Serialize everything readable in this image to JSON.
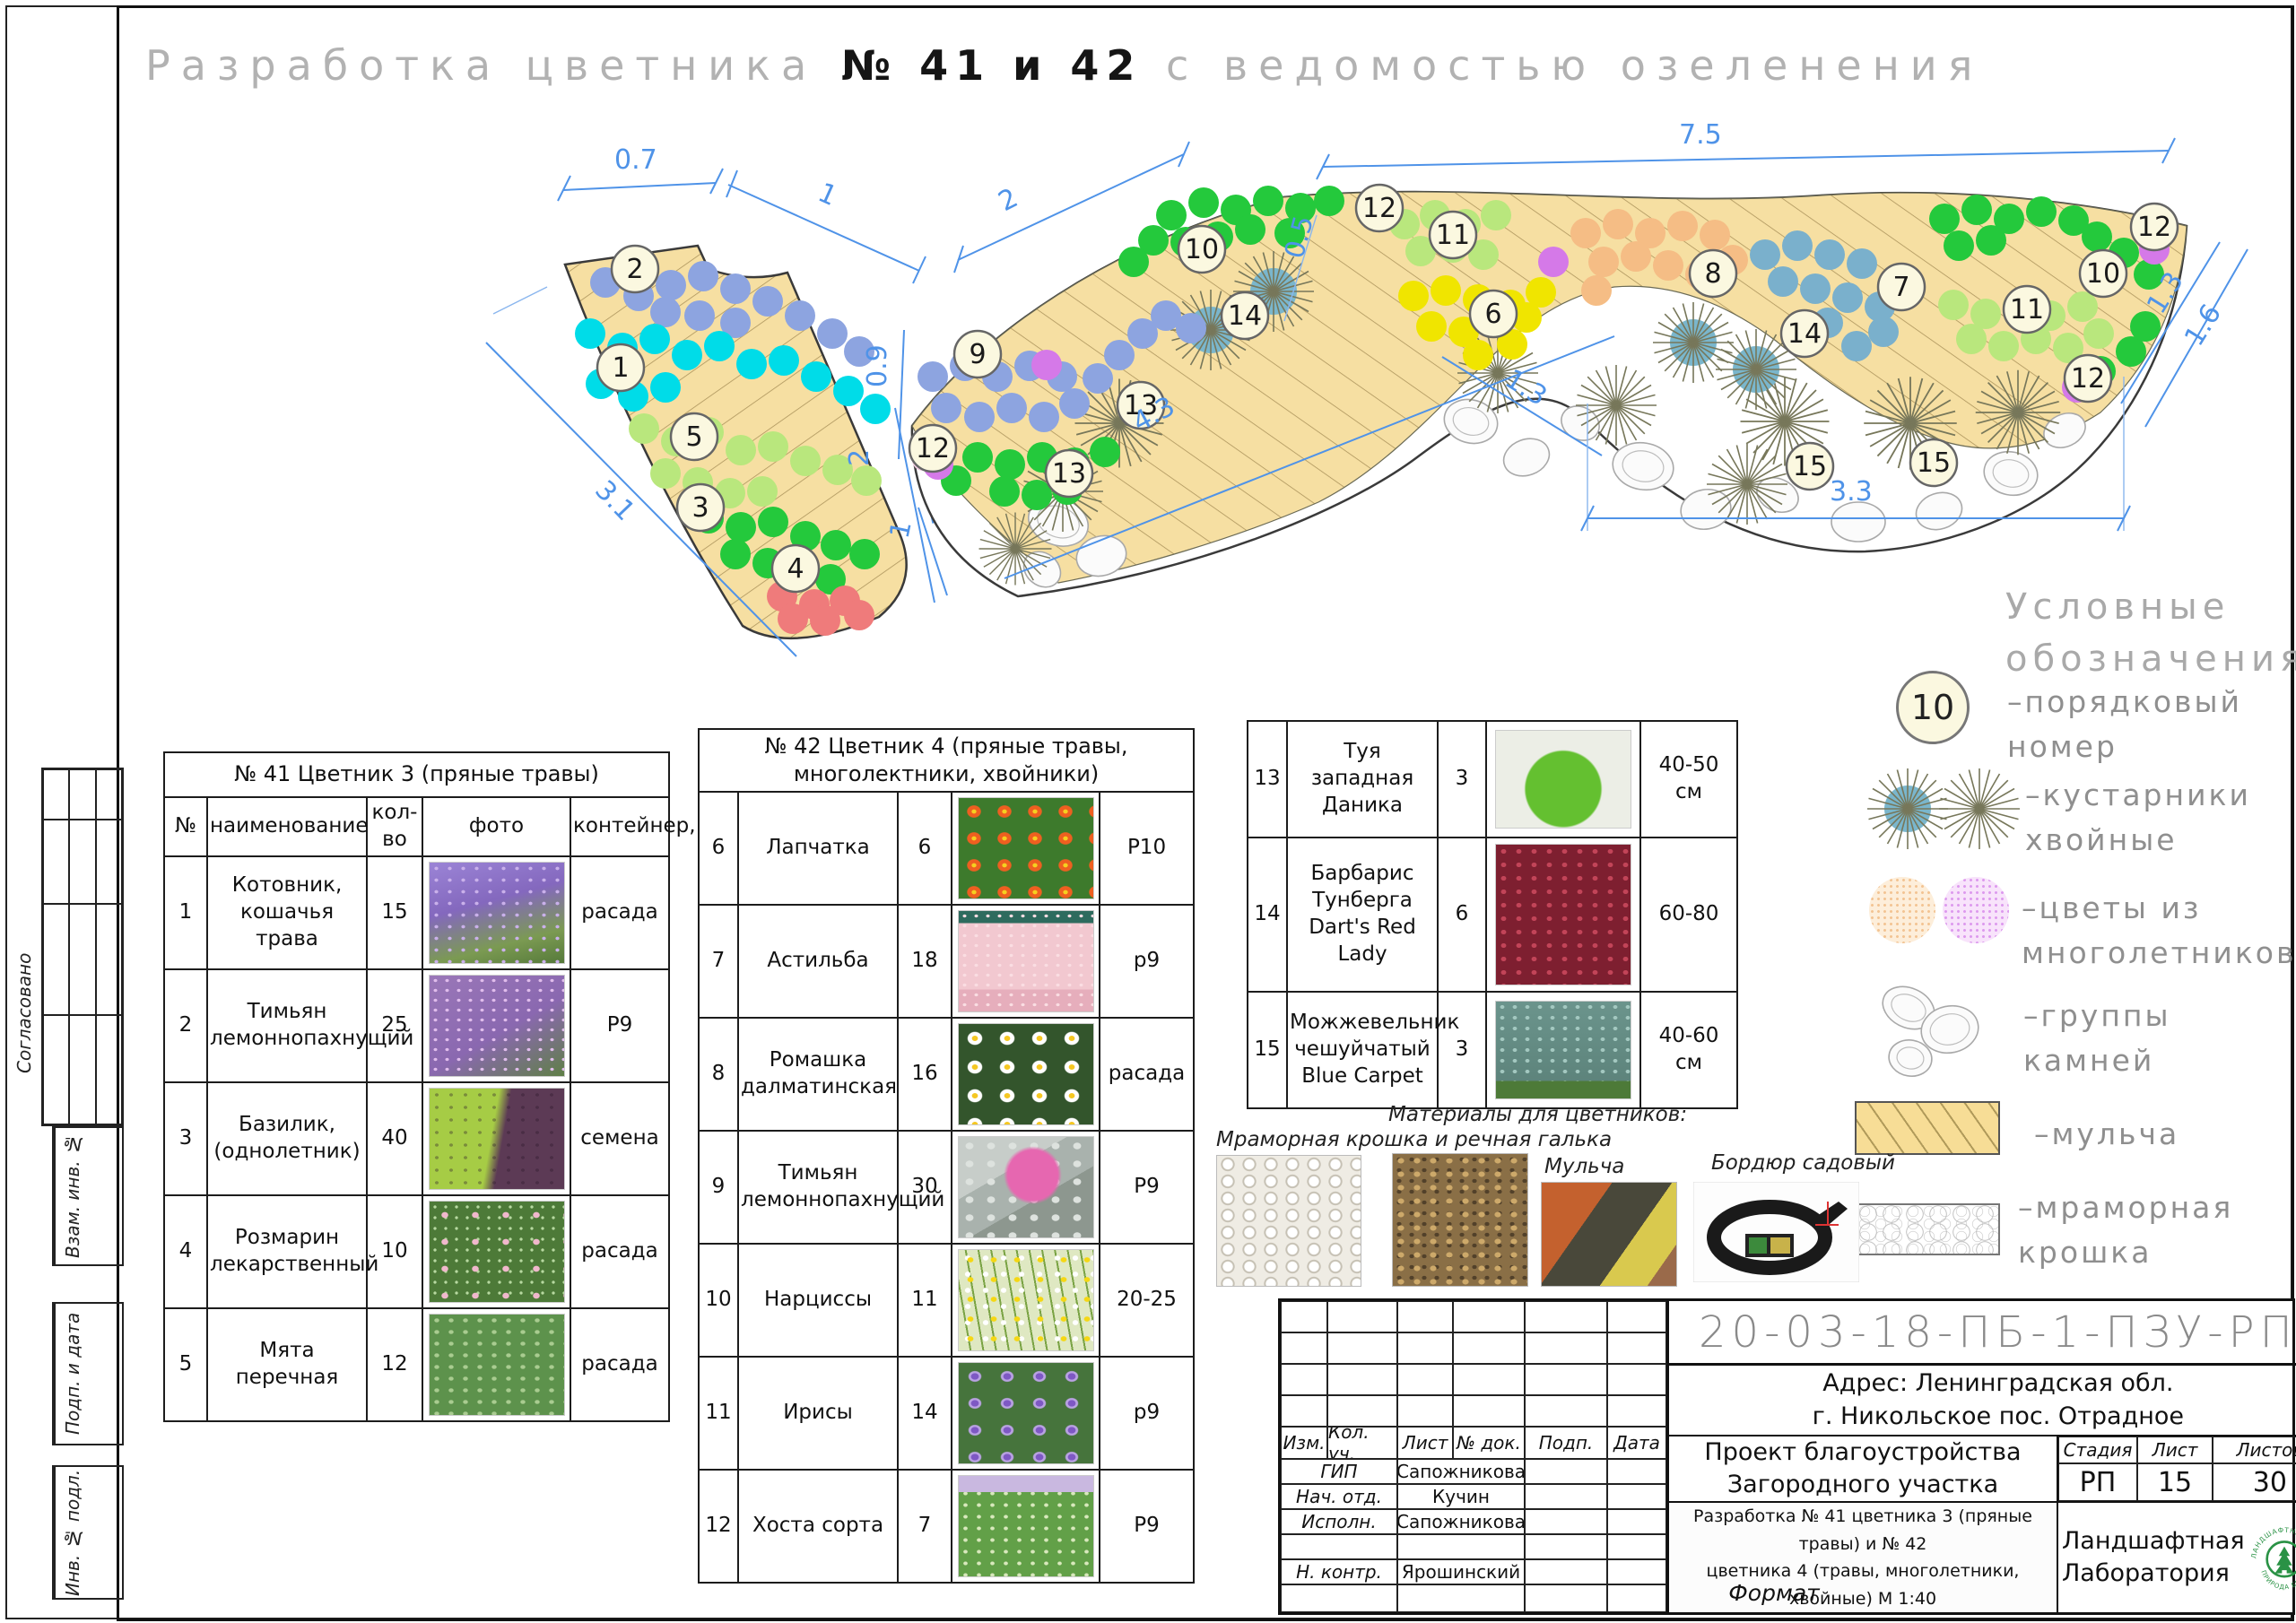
{
  "sheet": {
    "title_prefix": "Разработка цветника",
    "title_number": "№ 41 и 42",
    "title_suffix": "с ведомостью озеленения",
    "format_label": "Формат"
  },
  "side": {
    "agreed": "Согласовано",
    "vzam": "Взам. инв. №",
    "podp": "Подп. и дата",
    "inv": "Инв. № подл."
  },
  "plan41": {
    "badges": [
      "2",
      "1",
      "5",
      "3",
      "4"
    ],
    "dims": [
      "0.7",
      "1",
      "3.1",
      "2"
    ]
  },
  "plan42": {
    "badges": [
      "9",
      "12",
      "13",
      "13",
      "10",
      "14",
      "12",
      "11",
      "6",
      "8",
      "7",
      "14",
      "11",
      "10",
      "12",
      "12",
      "15",
      "15"
    ],
    "dims": [
      "2",
      "7.5",
      "0.5",
      "0.9",
      "2",
      "1",
      "4.3",
      "1.3",
      "3.3",
      "1.3",
      "1.6"
    ]
  },
  "legend": {
    "title1": "Условные",
    "title2": "обозначения",
    "sample_number": "10",
    "items": [
      {
        "l1": "–порядковый",
        "l2": "номер"
      },
      {
        "l1": "–кустарники",
        "l2": "хвойные"
      },
      {
        "l1": "–цветы из",
        "l2": "многолетников"
      },
      {
        "l1": "–группы",
        "l2": "камней"
      },
      {
        "l1": "–мульча",
        "l2": ""
      },
      {
        "l1": "–мраморная",
        "l2": "крошка"
      }
    ]
  },
  "table41": {
    "title": "№ 41 Цветник 3 (пряные травы)",
    "col_num": "№",
    "col_name": "наименование",
    "col_qty": "кол-во",
    "col_photo": "фото",
    "col_cont": "контейнер,",
    "rows": [
      {
        "num": "1",
        "name": "Котовник, кошачья трава",
        "qty": "15",
        "cont": "расада"
      },
      {
        "num": "2",
        "name": "Тимьян лемоннопахнущий",
        "qty": "25",
        "cont": "Р9"
      },
      {
        "num": "3",
        "name": "Базилик, (однолетник)",
        "qty": "40",
        "cont": "семена"
      },
      {
        "num": "4",
        "name": "Розмарин лекарственный",
        "qty": "10",
        "cont": "расада"
      },
      {
        "num": "5",
        "name": "Мята перечная",
        "qty": "12",
        "cont": "расада"
      }
    ]
  },
  "table42": {
    "title": "№ 42 Цветник 4 (пряные травы, многолектники, хвойники)",
    "rows": [
      {
        "num": "6",
        "name": "Лапчатка",
        "qty": "6",
        "cont": "P10"
      },
      {
        "num": "7",
        "name": "Астильба",
        "qty": "18",
        "cont": "p9"
      },
      {
        "num": "8",
        "name": "Ромашка далматинская",
        "qty": "16",
        "cont": "расада"
      },
      {
        "num": "9",
        "name": "Тимьян лемоннопахнущий",
        "qty": "30",
        "cont": "Р9"
      },
      {
        "num": "10",
        "name": "Нарциссы",
        "qty": "11",
        "cont": "20-25"
      },
      {
        "num": "11",
        "name": "Ирисы",
        "qty": "14",
        "cont": "p9"
      },
      {
        "num": "12",
        "name": "Хоста сорта",
        "qty": "7",
        "cont": "Р9"
      }
    ]
  },
  "shrubs": {
    "rows": [
      {
        "num": "13",
        "name": "Туя западная Даника",
        "qty": "3",
        "size": "40-50 см"
      },
      {
        "num": "14",
        "name": "Барбарис Тунберга Dart's Red Lady",
        "qty": "6",
        "size": "60-80"
      },
      {
        "num": "15",
        "name": "Можжевельник чешуйчатый Blue Carpet",
        "qty": "3",
        "size": "40-60 см"
      }
    ]
  },
  "materials": {
    "title": "Материалы для цветников:",
    "marble_label": "Мраморная крошка и речная галька",
    "mulch_label": "Мульча",
    "border_label": "Бордюр садовый"
  },
  "tb": {
    "code": "20-03-18-ПБ-1-ПЗУ-РП",
    "addr1": "Адрес: Ленинградская обл.",
    "addr2": "г. Никольское пос. Отрадное",
    "h": [
      "Изм.",
      "Кол. уч.",
      "Лист",
      "№ док.",
      "Подп.",
      "Дата"
    ],
    "roles": [
      {
        "role": "ГИП",
        "name": "Сапожникова"
      },
      {
        "role": "Нач. отд.",
        "name": "Кучин"
      },
      {
        "role": "Исполн.",
        "name": "Сапожникова"
      },
      {
        "role": "",
        "name": ""
      },
      {
        "role": "Н. контр.",
        "name": "Ярошинский"
      }
    ],
    "proj1": "Проект благоустройства",
    "proj2": "Загородного участка",
    "stage_l": "Стадия",
    "list_l": "Лист",
    "sheets_l": "Листов",
    "stage": "РП",
    "list": "15",
    "sheets": "30",
    "desc1": "Разработка № 41 цветника 3 (пряные травы) и № 42",
    "desc2": "цветника 4 (травы, многолетники, хвойные) М 1:40",
    "comp1": "Ландшафтная",
    "comp2": "Лаборатория",
    "logo_top": "ЛАНДШАФТНАЯ ЛАБОРАТОРИЯ",
    "logo_bottom": "ПРИРОДА БЕЗ ХИМИИ"
  }
}
